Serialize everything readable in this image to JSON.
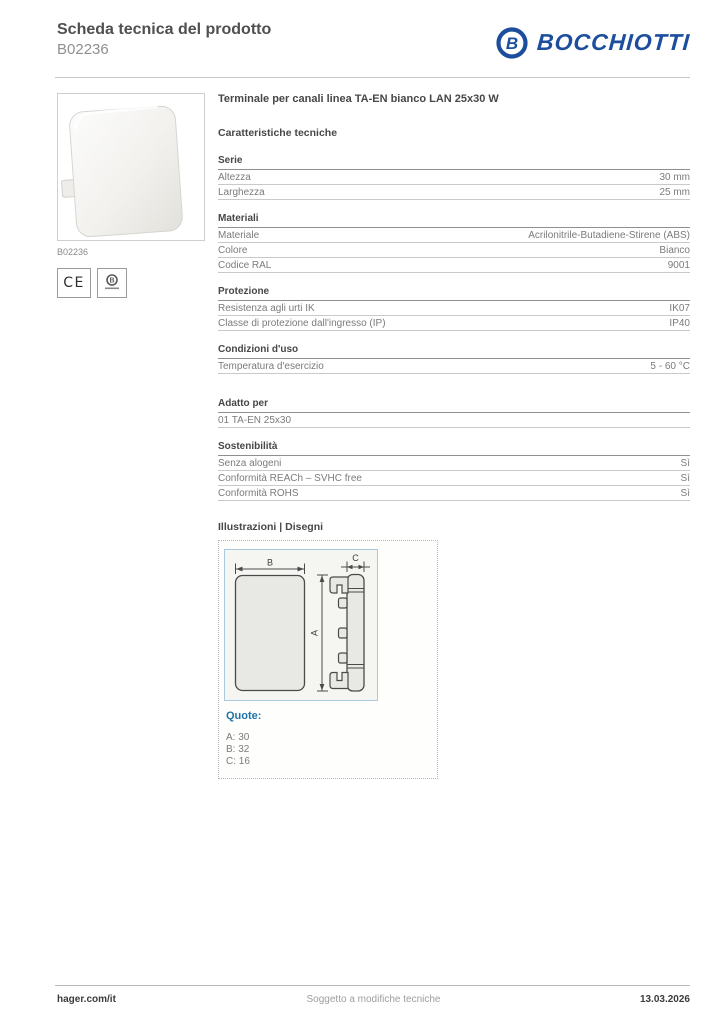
{
  "header": {
    "title": "Scheda tecnica del prodotto",
    "subtitle": "B02236",
    "brand": {
      "name": "BOCCHIOTTI",
      "icon": "circle-b-icon",
      "icon_letter": "B",
      "color": "#1c4e9d"
    }
  },
  "product_panel": {
    "caption": "B02236",
    "ce_label": "CE",
    "quality_mark": "circle-b-quality-icon"
  },
  "specs": {
    "product_title": "Terminale per canali linea TA-EN bianco LAN 25x30 W",
    "heading": "Caratteristiche tecniche",
    "sections": [
      {
        "title": "Serie",
        "rows": [
          {
            "label": "Altezza",
            "value": "30 mm"
          },
          {
            "label": "Larghezza",
            "value": "25 mm"
          }
        ]
      },
      {
        "title": "Materiali",
        "rows": [
          {
            "label": "Materiale",
            "value": "Acrilonitrile-Butadiene-Stirene (ABS)"
          },
          {
            "label": "Colore",
            "value": "Bianco"
          },
          {
            "label": "Codice RAL",
            "value": "9001"
          }
        ]
      },
      {
        "title": "Protezione",
        "rows": [
          {
            "label": "Resistenza agli urti IK",
            "value": "IK07"
          },
          {
            "label": "Classe di protezione dall'ingresso (IP)",
            "value": "IP40"
          }
        ]
      },
      {
        "title": "Condizioni d'uso",
        "rows": [
          {
            "label": "Temperatura d'esercizio",
            "value": "5 - 60 °C"
          }
        ]
      },
      {
        "title": "Adatto per",
        "rows": [
          {
            "label": "01 TA-EN 25x30",
            "value": ""
          }
        ]
      },
      {
        "title": "Sostenibilità",
        "rows": [
          {
            "label": "Senza alogeni",
            "value": "Sì"
          },
          {
            "label": "Conformità REACh – SVHC free",
            "value": "Sì"
          },
          {
            "label": "Conformità ROHS",
            "value": "Sì"
          }
        ]
      }
    ]
  },
  "illustrations": {
    "heading": "Illustrazioni | Disegni",
    "drawing": {
      "dim_labels": {
        "a": "A",
        "b": "B",
        "c": "C"
      },
      "quote_heading": "Quote:",
      "quotes": [
        "A: 30",
        "B: 32",
        "C: 16"
      ],
      "border_color": "#a9c9dc"
    }
  },
  "footer": {
    "left": "hager.com/it",
    "center": "Soggetto a modifiche tecniche",
    "right": "13.03.2026"
  }
}
